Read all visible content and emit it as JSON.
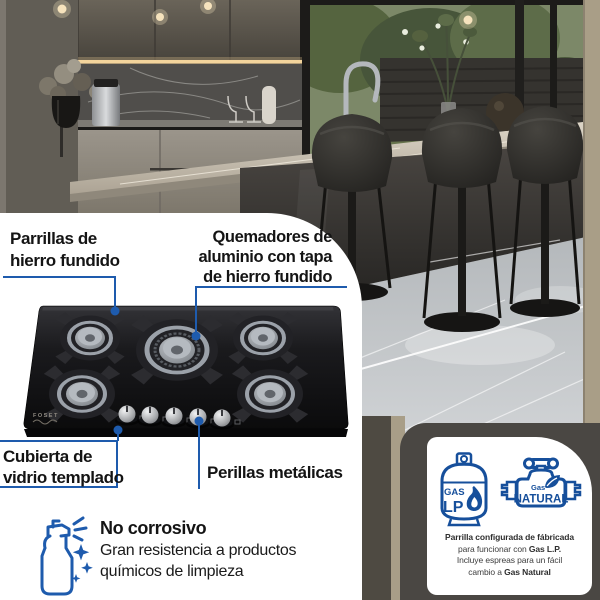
{
  "product_labels": {
    "parrillas": {
      "line1": "Parrillas de",
      "line2": "hierro fundido"
    },
    "quemadores": {
      "line1": "Quemadores de",
      "line2": "aluminio con tapa",
      "line3": "de hierro fundido"
    },
    "cubierta": {
      "line1": "Cubierta de",
      "line2": "vidrio templado"
    },
    "perillas": {
      "label": "Perillas metálicas"
    }
  },
  "no_corrosivo": {
    "title": "No corrosivo",
    "line1": "Gran resistencia a productos",
    "line2": "químicos de limpieza"
  },
  "brand": {
    "name": "FOSET"
  },
  "gas_card": {
    "lp_icon": {
      "gas": "GAS",
      "lp": "LP"
    },
    "natural_icon": {
      "gas": "Gas",
      "natural": "NATURAL"
    },
    "note": {
      "line1": "Parrilla configurada de fábricada",
      "line2_pre": "para funcionar con ",
      "line2_bold": "Gas L.P.",
      "line3": "Incluye espreas para un fácil",
      "line4_pre": "cambio a ",
      "line4_bold": "Gas Natural"
    }
  },
  "colors": {
    "callout_blue": "#1e5bad",
    "icon_blue": "#164f9b",
    "dark_card_bg": "#4a4743",
    "cooktop_black": "#141416"
  }
}
